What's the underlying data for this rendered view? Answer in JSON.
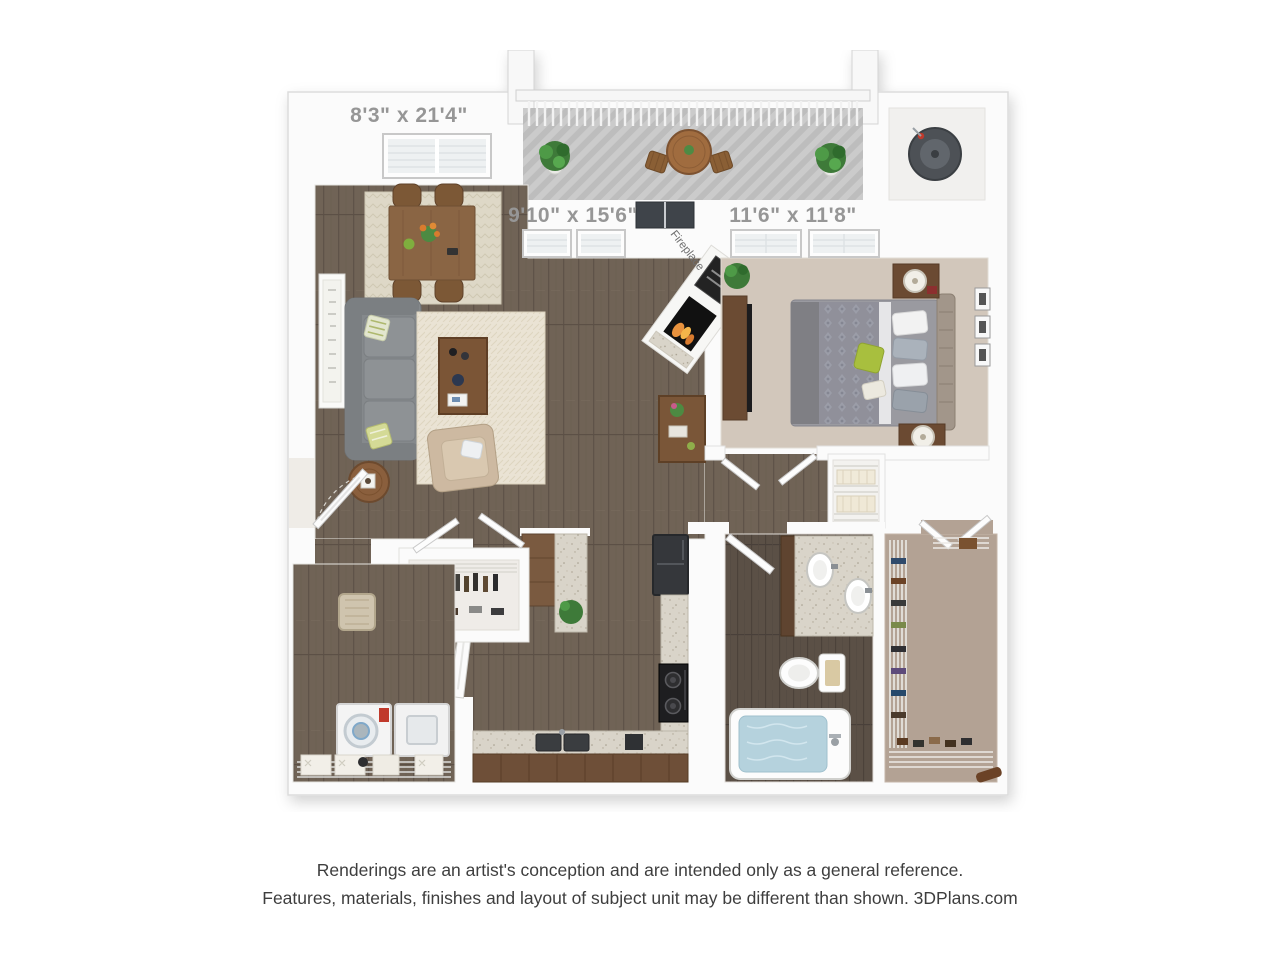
{
  "plan": {
    "dimensions": {
      "balcony_label": "8'3\" x 21'4\"",
      "living_label": "9'10\" x 15'6\"",
      "bedroom_label": "11'6\" x 11'8\""
    },
    "fireplace_label": "Fireplace",
    "label_color": "#969696"
  },
  "disclaimer": {
    "line1": "Renderings are an artist's conception and are intended only as a general reference.",
    "line2": "Features, materials, finishes and layout of subject unit may be different than shown. 3DPlans.com"
  },
  "palette": {
    "wall_white": "#fbfbfb",
    "wood_floor": "#706356",
    "dark_wood_floor": "#5a4f45",
    "bedroom_carpet": "#d2c7bb",
    "closet_carpet": "#b3a294",
    "granite": "#d9d4c9",
    "cabinet_wood": "#6e4f38",
    "sofa_gray": "#85898c",
    "accent_green": "#a8bf3e",
    "tub_water_blue": "#b5d2dd",
    "appliance_black": "#35373b",
    "label_gray": "#969696",
    "disclaimer_text": "#3e3e3e"
  }
}
